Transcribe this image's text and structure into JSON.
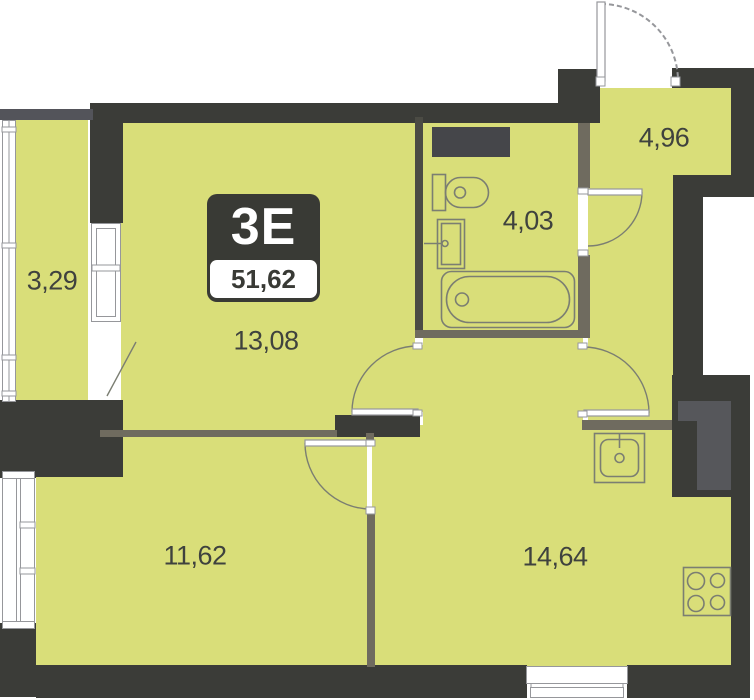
{
  "unit_badge": {
    "unit_type": "3E",
    "total_area": "51,62"
  },
  "rooms": [
    {
      "name": "loggia",
      "area": "3,29"
    },
    {
      "name": "living-room",
      "area": "13,08"
    },
    {
      "name": "bathroom",
      "area": "4,03"
    },
    {
      "name": "hallway",
      "area": "4,96"
    },
    {
      "name": "bedroom",
      "area": "11,62"
    },
    {
      "name": "kitchen-living-room",
      "area": "14,64"
    }
  ],
  "fixtures": [
    "toilet",
    "washbasin",
    "bathtub",
    "kitchen-sink",
    "stove-4-burners",
    "entry-door",
    "bathroom-door",
    "living-room-door",
    "kitchen-door",
    "bedroom-door",
    "loggia-door",
    "ventilation-shaft",
    "windows"
  ],
  "colors": {
    "room_fill": "#d9de79",
    "wall": "#3b3c38",
    "partition": "#6f6b5f",
    "divider": "#4b4b44",
    "duct": "#45464a",
    "shaft": "#56575b",
    "outline": "#7b7e72",
    "glazing": "#96979b",
    "label_text": "#3f423e",
    "badge_bg": "#393a35",
    "badge_text": "#ffffff",
    "bg": "#ffffff"
  }
}
